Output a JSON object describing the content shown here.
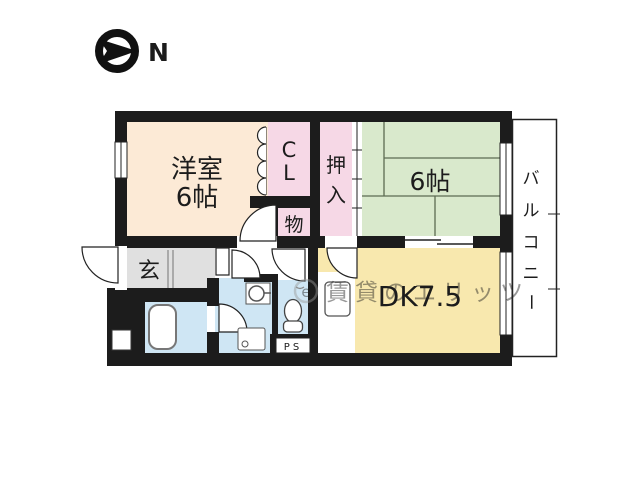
{
  "colors": {
    "wall": "#1c1c1c",
    "western_room": "#fcead6",
    "closet_pink": "#f6d8e6",
    "tatami_green": "#d9e9cc",
    "dk_yellow": "#f8e8ae",
    "hall_gray": "#e0e0e0",
    "wet_blue": "#cfe6f4",
    "watermark_gray": "#9aa0a8"
  },
  "compass": {
    "label": "N"
  },
  "rooms": {
    "western_room": {
      "name_line1": "洋室",
      "name_line2": "6帖"
    },
    "closet": {
      "c1": "C",
      "c2": "L"
    },
    "storage": {
      "label": "物"
    },
    "oshiire": {
      "c1": "押",
      "c2": "入"
    },
    "tatami_room": {
      "label": "6帖"
    },
    "entrance": {
      "label": "玄"
    },
    "dining_kitchen": {
      "label": "DK7.5"
    },
    "pipe_space": {
      "label": "PS"
    },
    "balcony": {
      "c1": "バ",
      "c2": "ル",
      "c3": "コ",
      "c4": "ニ",
      "c5": "ー"
    }
  },
  "watermark": {
    "logo_letter": "e",
    "text": "賃貸のエリッツ"
  }
}
